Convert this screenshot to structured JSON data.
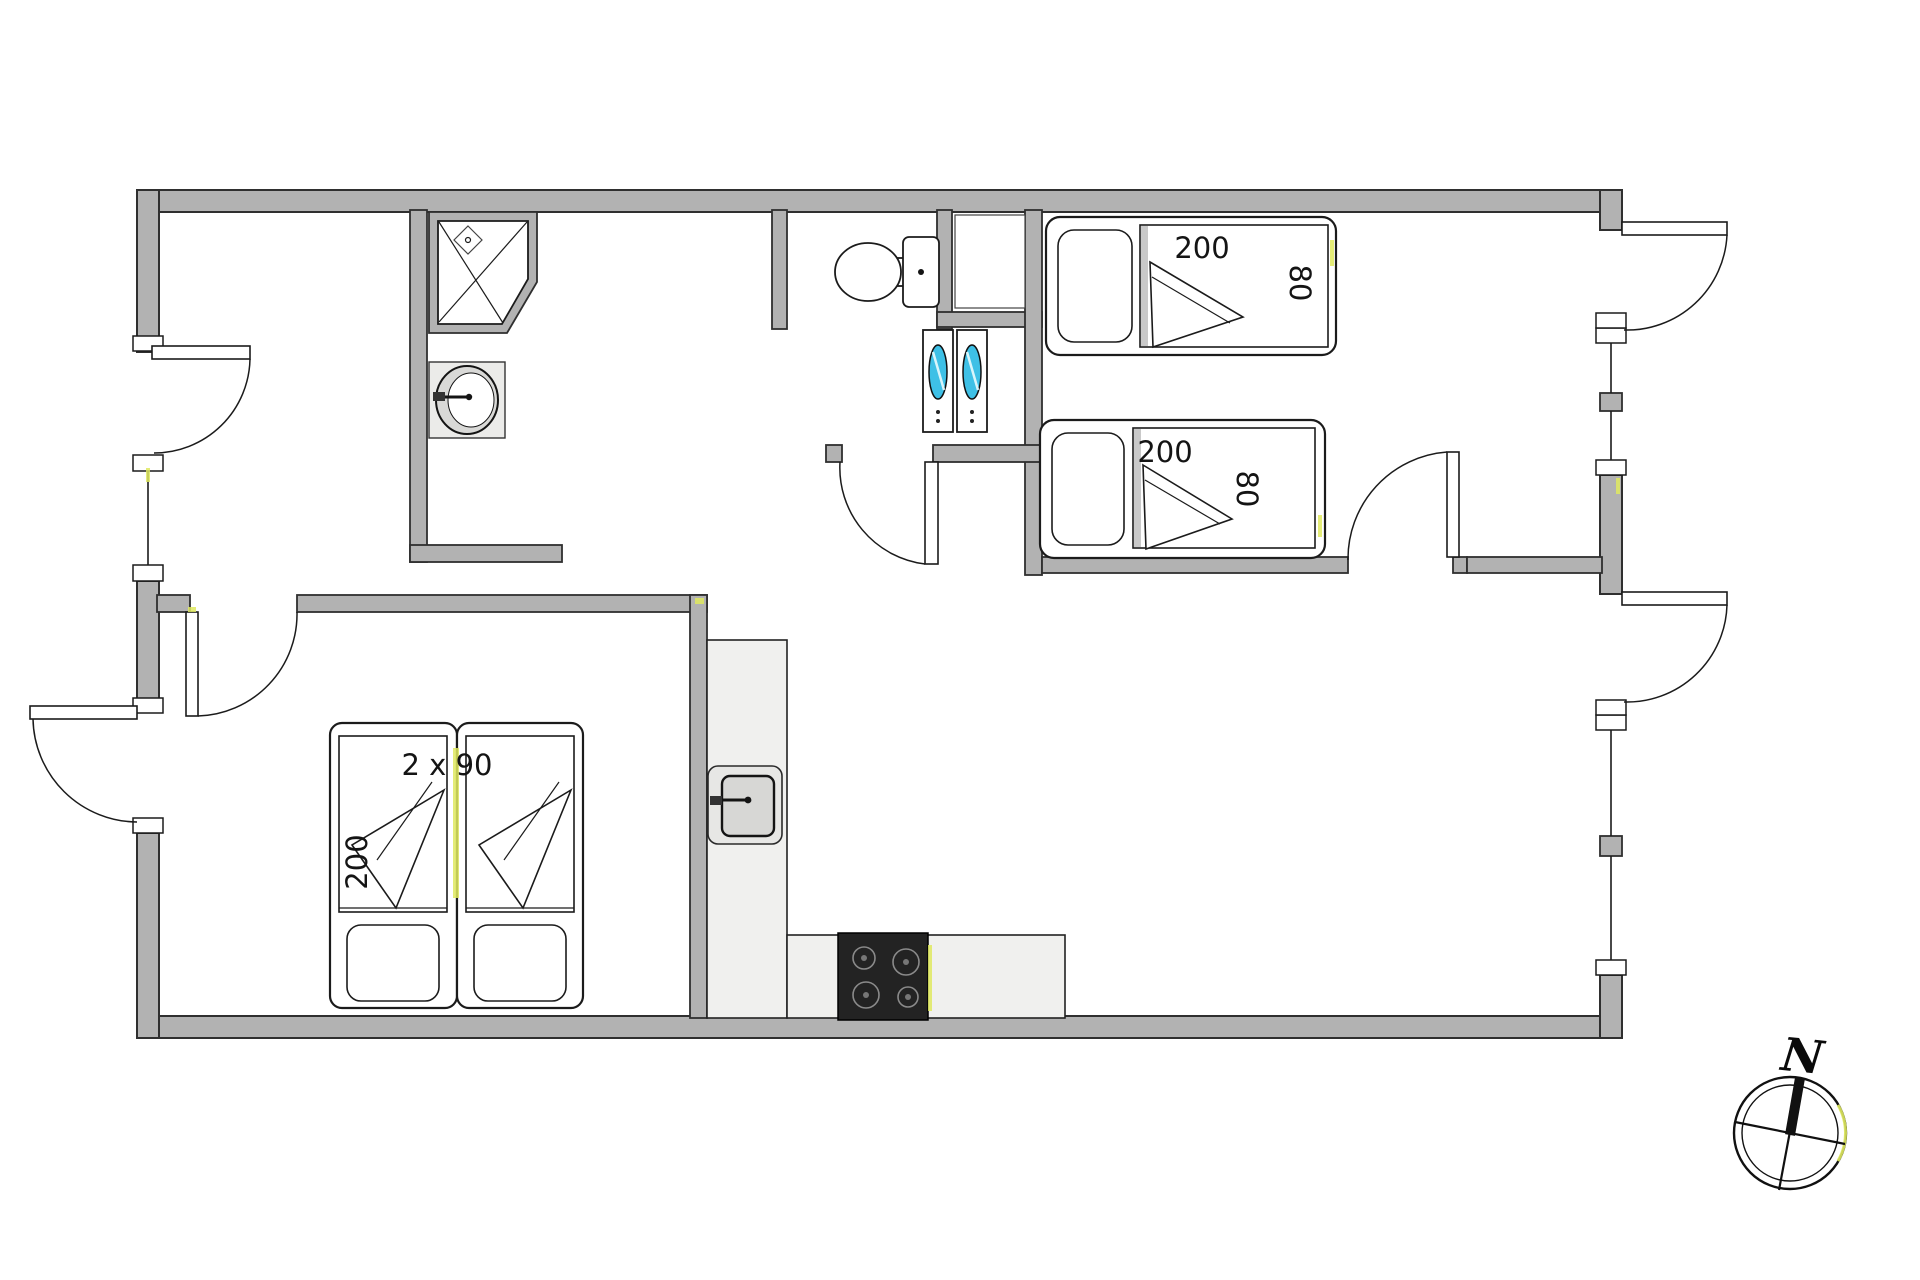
{
  "page": {
    "type": "architectural-floor-plan",
    "background": "#ffffff"
  },
  "colors": {
    "wall": "#b2b2b2",
    "wall_outline": "#2f2f2f",
    "line": "#1b1b1b",
    "counter": "#f0f0ee",
    "stove": "#232323",
    "laundry_door": "#3ec0e6",
    "highlight": "#dfe95f"
  },
  "beds": {
    "right_top": {
      "length": "200",
      "width": "80"
    },
    "right_bottom": {
      "length": "200",
      "width": "80"
    },
    "left_pair": {
      "size": "2 x 90",
      "length": "200"
    }
  },
  "compass": {
    "north": "N"
  },
  "fixtures": [
    "corner-shower",
    "washbasin",
    "toilet",
    "closet-niche",
    "washer-dryer",
    "kitchen-sink",
    "stove",
    "kitchen-counter"
  ]
}
